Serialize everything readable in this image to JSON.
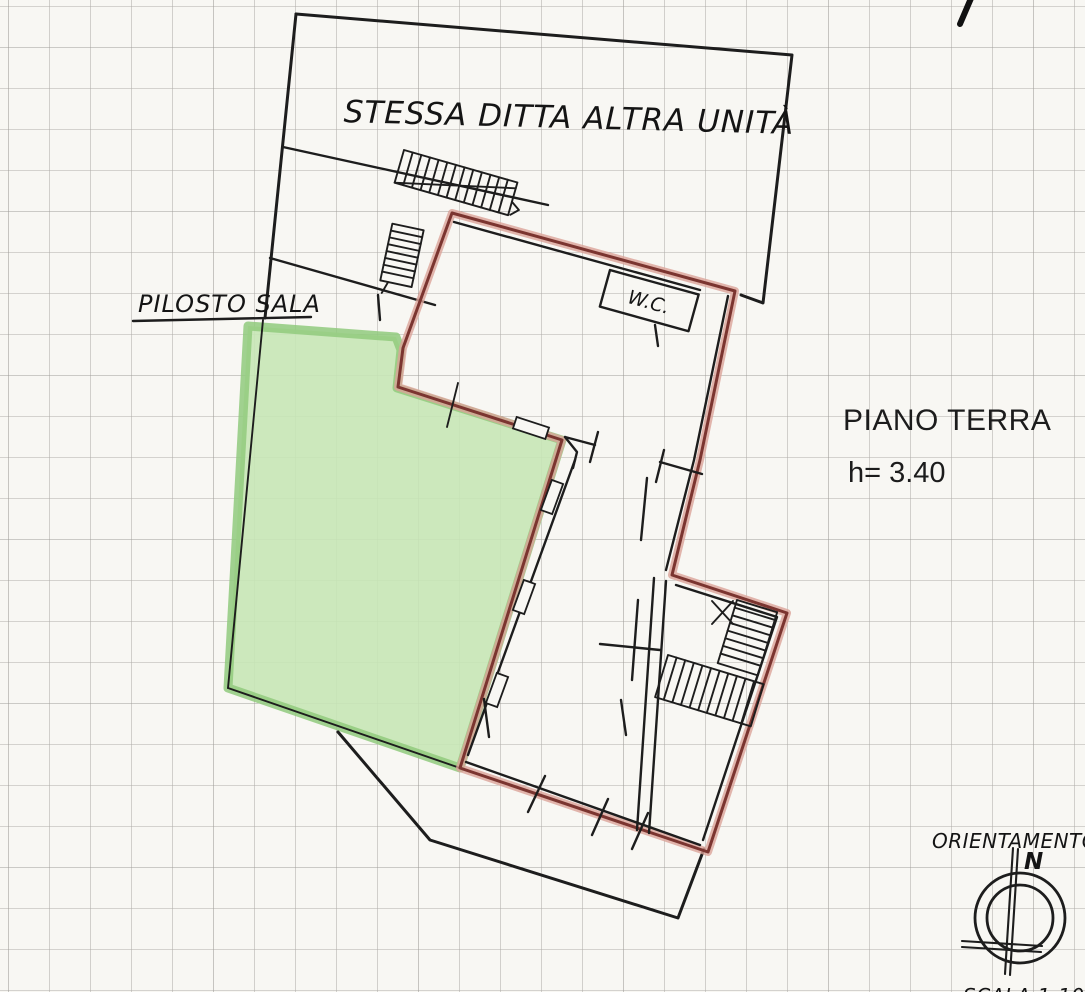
{
  "plan": {
    "adjacent_unit_label": "STESSA DITTA ALTRA UNITÀ",
    "sala_label": "PILOSTO SALA",
    "wc_label": "W.C.",
    "floor_label": "PIANO TERRA",
    "height_label": "h= 3.40",
    "scale_label": "SCALA 1:100"
  },
  "compass": {
    "title": "ORIENTAMENTO",
    "north": "N"
  },
  "colors": {
    "paper": "#f8f7f3",
    "grid_line": "#b0aeaa",
    "grid_dark": "#8f8d89",
    "ink": "#1d1d1d",
    "red_core": "#7b3530",
    "red_glow": "#dba399",
    "green_fill": "#c7e6b6",
    "green_border": "#90ca7d"
  }
}
